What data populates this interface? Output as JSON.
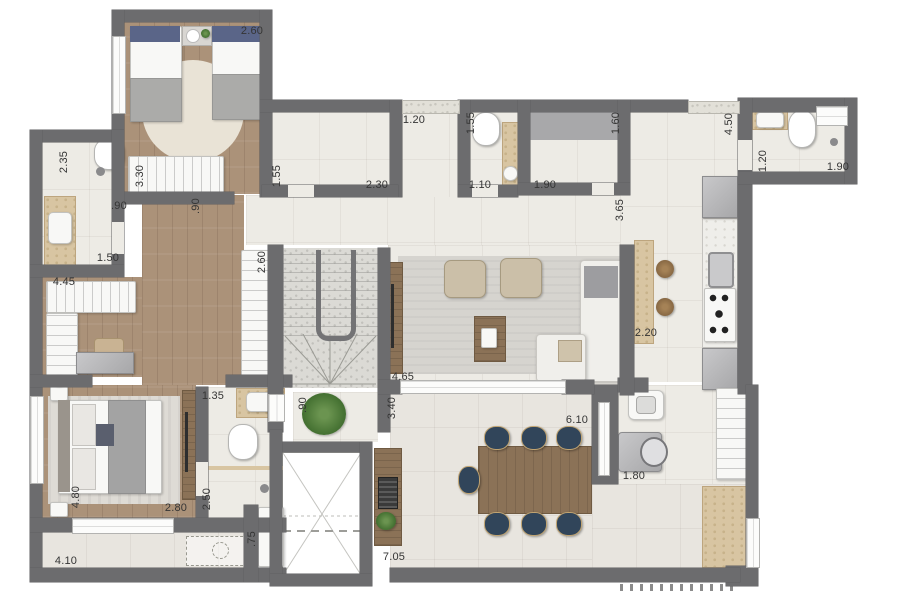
{
  "floor_plan": {
    "kind": "residential apartment floor plan (top view, rendered)",
    "units": "meters",
    "colors": {
      "wall": "#6c6c6e",
      "tile_floor": "#edebe5",
      "terrace_floor": "#e8e5df",
      "wood_floor": "#ab9279",
      "stair_granite": "#dbdad5",
      "counter_travertine": "#d8c5a2",
      "dining_chair_navy": "#31455a",
      "furniture_white": "#f8f8f6",
      "appliance_gray": "#b0b0b2",
      "plant_green": "#4a7636",
      "label_text": "#353535"
    },
    "dimension_labels": [
      {
        "text": "2.60",
        "x": 252,
        "y": 31,
        "vertical": false
      },
      {
        "text": "2.35",
        "x": 64,
        "y": 162,
        "vertical": true
      },
      {
        "text": "3.30",
        "x": 140,
        "y": 176,
        "vertical": true
      },
      {
        "text": ".90",
        "x": 119,
        "y": 206,
        "vertical": false
      },
      {
        "text": ".90",
        "x": 196,
        "y": 206,
        "vertical": true
      },
      {
        "text": "1.55",
        "x": 277,
        "y": 176,
        "vertical": true
      },
      {
        "text": "2.30",
        "x": 377,
        "y": 185,
        "vertical": false
      },
      {
        "text": "1.20",
        "x": 414,
        "y": 120,
        "vertical": false
      },
      {
        "text": "1.55",
        "x": 471,
        "y": 123,
        "vertical": true
      },
      {
        "text": "1.10",
        "x": 480,
        "y": 185,
        "vertical": false
      },
      {
        "text": "1.90",
        "x": 545,
        "y": 185,
        "vertical": false
      },
      {
        "text": "1.60",
        "x": 616,
        "y": 123,
        "vertical": true
      },
      {
        "text": "3.65",
        "x": 620,
        "y": 210,
        "vertical": true
      },
      {
        "text": "4.50",
        "x": 729,
        "y": 124,
        "vertical": true
      },
      {
        "text": "1.20",
        "x": 763,
        "y": 161,
        "vertical": true
      },
      {
        "text": "1.90",
        "x": 838,
        "y": 167,
        "vertical": false
      },
      {
        "text": "1.50",
        "x": 108,
        "y": 258,
        "vertical": false
      },
      {
        "text": "4.45",
        "x": 64,
        "y": 282,
        "vertical": false
      },
      {
        "text": "2.60",
        "x": 262,
        "y": 262,
        "vertical": true
      },
      {
        "text": "2.20",
        "x": 646,
        "y": 333,
        "vertical": false
      },
      {
        "text": "4.65",
        "x": 403,
        "y": 377,
        "vertical": false
      },
      {
        "text": "1.35",
        "x": 213,
        "y": 396,
        "vertical": false
      },
      {
        "text": ".90",
        "x": 303,
        "y": 405,
        "vertical": true
      },
      {
        "text": "3.40",
        "x": 392,
        "y": 408,
        "vertical": true
      },
      {
        "text": "6.10",
        "x": 577,
        "y": 420,
        "vertical": false
      },
      {
        "text": "1.80",
        "x": 634,
        "y": 476,
        "vertical": false
      },
      {
        "text": "2.50",
        "x": 207,
        "y": 499,
        "vertical": true
      },
      {
        "text": "2.80",
        "x": 176,
        "y": 508,
        "vertical": false
      },
      {
        "text": "4.80",
        "x": 76,
        "y": 497,
        "vertical": true
      },
      {
        "text": ".75",
        "x": 252,
        "y": 539,
        "vertical": true
      },
      {
        "text": "4.10",
        "x": 66,
        "y": 561,
        "vertical": false
      },
      {
        "text": "7.05",
        "x": 394,
        "y": 557,
        "vertical": false
      }
    ]
  }
}
